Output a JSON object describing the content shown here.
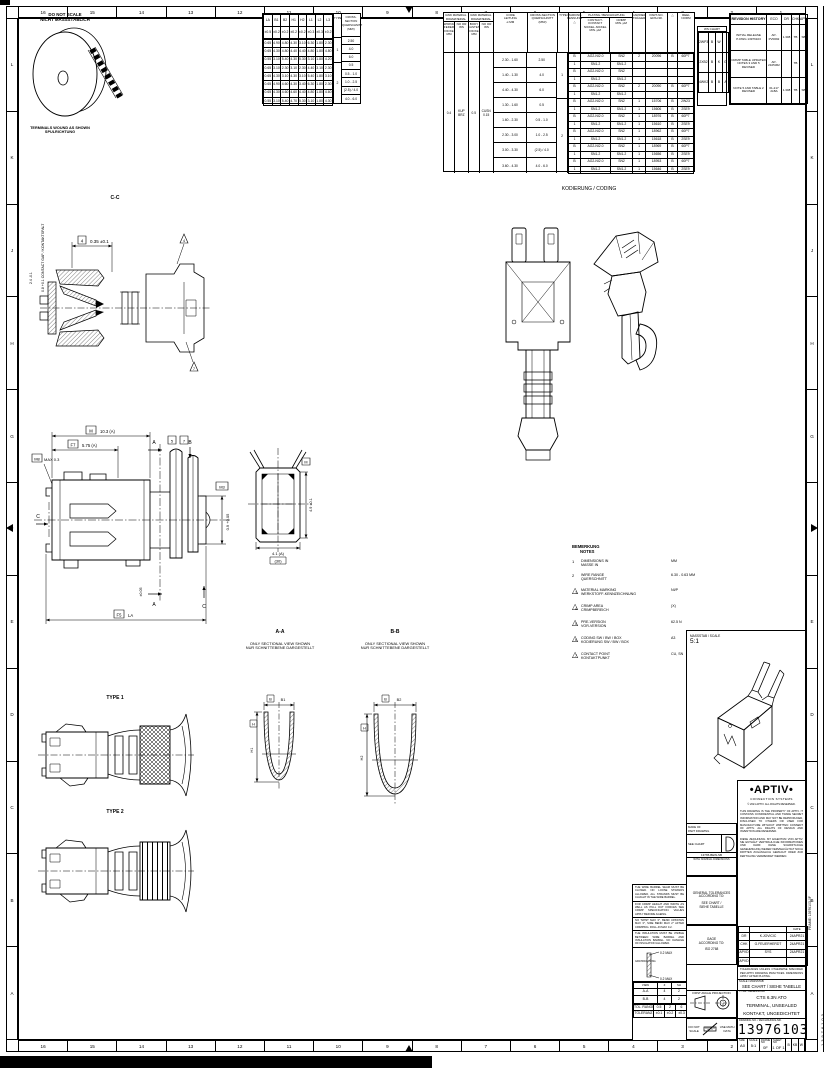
{
  "sheet": {
    "zones_h": [
      "16",
      "15",
      "14",
      "13",
      "12",
      "11",
      "10",
      "9",
      "8",
      "7",
      "6",
      "5",
      "4",
      "3",
      "2",
      "1"
    ],
    "zones_v": [
      "L",
      "K",
      "J",
      "H",
      "G",
      "F",
      "E",
      "D",
      "C",
      "B",
      "A"
    ],
    "frame_note": "FRAME: 13976103-0F",
    "doc_note": "13976103"
  },
  "top_left": {
    "dns1": "DO NOT SCALE",
    "dns2": "NICHT MASSSTÄBLICH",
    "wound1": "TERMINALS WOUND AS SHOWN",
    "wound2": "SPULRICHTUNG"
  },
  "dim_table": {
    "hdr_rows": [
      [
        "LA",
        "B1",
        "B2",
        "H1",
        "H2",
        "L1",
        "L2",
        "L3"
      ],
      [
        "±0.5",
        "±0.2",
        "±0.2",
        "±0.2",
        "±0.2",
        "±0.3",
        "±0.3",
        "±0.2"
      ]
    ],
    "h_type": "TYPE",
    "h_cs": "CROSS-SECTION\nQUERSCHNITT\n(MM²)",
    "rows": [
      [
        "0.65",
        "4.90",
        "4.80",
        "4.30",
        "3.10",
        "6.30",
        "1.80",
        "2.30"
      ],
      [
        "0.65",
        "4.30",
        "4.80",
        "4.40",
        "4.40",
        "4.80",
        "1.80",
        "4.80"
      ],
      [
        "0.55",
        "3.10",
        "5.40",
        "4.30",
        "5.30",
        "3.10",
        "1.80",
        "4.20"
      ],
      [
        "0.65",
        "3.10",
        "2.30",
        "3.10",
        "2.30",
        "4.40",
        "3.10",
        "2.30"
      ],
      [
        "0.65",
        "4.30",
        "3.10",
        "4.30",
        "3.10",
        "5.40",
        "1.80",
        "3.10"
      ],
      [
        "0.65",
        "4.90",
        "4.60",
        "4.30",
        "3.40",
        "6.30",
        "1.80",
        "2.30"
      ],
      [
        "0.65",
        "4.30",
        "4.60",
        "4.60",
        "4.40",
        "4.80",
        "1.80",
        "4.60"
      ],
      [
        "0.55",
        "3.10",
        "5.40",
        "4.70",
        "5.30",
        "3.10",
        "1.80",
        "4.30"
      ]
    ],
    "type1": "1",
    "type2": "2",
    "cs": [
      "2.50",
      "4.0",
      "6.0",
      "0.5",
      "0.5 - 1.0",
      "1.0 - 2.5",
      "(2.5) / 4.0",
      "4.0 - 6.0"
    ]
  },
  "mat_table": {
    "h_raw1": "RAW MATERIAL\nROHMATERIAL",
    "h_spring": "SPRING\nFEDER\nDICKE MM",
    "h_ws1": "NO OR\nWS",
    "h_raw2": "RAW MATERIAL\nROHMATERIAL",
    "h_body": "BODY\nKASTEN\nDICKE MM",
    "h_ws2": "NO OR\nWS",
    "h_core": "CORE\nLEITUNG\n⌀ MM",
    "h_cs": "CROSS-SECTION\nQUERSCHNITT\n(MM²)",
    "h_type": "TYPE",
    "h_mark": "MARKING\nKENNUNG\n△",
    "h_plating": "PLATING / BESCHICHTUNG",
    "h_contact": "CONTACT-KONTAKT\nNICKEL-NICKEL\nMIN. µM",
    "h_crimp": "CRIMP\nMIN. µM",
    "h_carrier": "CARRIER\nTRÄGER",
    "h_part": "PART-NO.\nEDS-NR.",
    "h_flag": "△",
    "h_norm": "REEL\nNORM",
    "spring_th": "0.4",
    "spring_ws": "KUP\nBRZ",
    "body_th": "0.5",
    "body_ws": "CUSN\n0.15",
    "core": [
      "2.30 - 1.60",
      "1.40 - 1.30",
      "4.40 - 4.30",
      "1.30 - 1.60",
      "1.60 - 2.30",
      "2.30 - 3.00",
      "3.00 - 3.30",
      "3.60 - 4.30"
    ],
    "cs": [
      "2.50",
      "4.0",
      "6.0",
      "0.5",
      "0.5 - 1.0",
      "1.0 - 2.5",
      "(2.5) / 4.0",
      "4.0 - 6.0"
    ],
    "type1": "1",
    "type2": "2",
    "rows": [
      [
        "B",
        "AG2-NI2.0",
        "SN2",
        "2",
        "20096",
        "B",
        "60P7"
      ],
      [
        "1",
        "SN1.2",
        "SN1.2",
        "",
        "",
        "",
        ""
      ],
      [
        "B",
        "AG2-NI2.0",
        "SN2",
        "",
        "",
        "",
        ""
      ],
      [
        "1",
        "SN1.2",
        "SN1.2",
        "",
        "",
        "",
        ""
      ],
      [
        "B",
        "AG2-NI2.0",
        "SN2",
        "2",
        "20090",
        "B",
        "60P7"
      ],
      [
        "1",
        "SN1.2",
        "SN1.2",
        "",
        "",
        "",
        ""
      ],
      [
        "B",
        "AG2-NI2.0",
        "SN2",
        "1",
        "15706",
        "B",
        "2W23"
      ],
      [
        "1",
        "SN1.2",
        "SN1.2",
        "1",
        "15606",
        "B",
        "2SE9"
      ],
      [
        "B",
        "AG2-NI2.0",
        "SN2",
        "1",
        "18976",
        "B",
        "60P7"
      ],
      [
        "1",
        "SN1.2",
        "SN1.2",
        "1",
        "15610",
        "B",
        "2SE9"
      ],
      [
        "B",
        "AG2-NI2.0",
        "SN2",
        "1",
        "18962",
        "B",
        "60P7"
      ],
      [
        "1",
        "SN1.2",
        "SN1.2",
        "1",
        "15618",
        "B",
        "2SE9"
      ],
      [
        "B",
        "AG2-NI2.0",
        "SN2",
        "1",
        "18969",
        "B",
        "60P7"
      ],
      [
        "1",
        "SN1.2",
        "SN1.2",
        "1",
        "15656",
        "B",
        "2SE9"
      ],
      [
        "B",
        "AG2-NI2.0",
        "SN2",
        "1",
        "18953",
        "B",
        "60P7"
      ],
      [
        "1",
        "SN1.2",
        "SN1.2",
        "1",
        "15646",
        "B",
        "2SE9"
      ]
    ]
  },
  "ws_table": {
    "title": "WS CHART",
    "rows": [
      [
        "2WP3",
        "B",
        "W",
        ""
      ],
      [
        "2XB2",
        "B",
        "K",
        "G"
      ],
      [
        "4WK2",
        "B",
        "B",
        "A"
      ]
    ]
  },
  "rev_table": {
    "title": "REVISION HISTORY",
    "cols": [
      "ECO",
      "DR",
      "CHK",
      "APVD"
    ],
    "rows": [
      [
        "INITIAL RELEASE\nP-DWG 13976103",
        "AP-\nPV0092",
        "1.308",
        "TB",
        "SB"
      ],
      [
        "CRIMP TABLE UPDATED\nNOTES 3 AND 5 REVISED",
        "AP-\n2105362",
        "",
        "TB",
        ""
      ],
      [
        "NOTE 5 AND TABLE 2 REVISED",
        "01-217\n2LBA",
        "1.308",
        "TB",
        "SB"
      ]
    ]
  },
  "notes": {
    "t1": "BEMERKUNG",
    "t2": "NOTES",
    "items": [
      {
        "f": "1",
        "en": "DIMENSIONS IN",
        "de": "MASSE IN",
        "val": "MM"
      },
      {
        "f": "2",
        "en": "WIRE RANGE",
        "de": "QUERSCHNITT",
        "val": "6.30 - 0.63 MM"
      },
      {
        "f": "3",
        "en": "MATERIAL MARKING",
        "de": "WERKSTOFF-KENNZEICHNUNG",
        "val": "NI/P"
      },
      {
        "f": "4",
        "en": "CRIMP AREA",
        "de": "CRIMPBEREICH",
        "val": "(X)"
      },
      {
        "f": "5",
        "en": "PRE-VERSION",
        "de": "VOR-VERSION",
        "val": "62.5 N"
      },
      {
        "f": "6",
        "en": "CODING SW / BW / BOX",
        "de": "KODIERUNG SW / BW / BOX",
        "val": "A3"
      },
      {
        "f": "7",
        "en": "CONTACT POINT",
        "de": "KONTAKTPUNKT",
        "val": "CU, SN"
      }
    ]
  },
  "dw": {
    "coding": "KODIERUNG / CODING",
    "cc_title": "C-C",
    "cc_dim": "0.35 ±0.1",
    "cc_balloon": "4",
    "cc_flag1": "4",
    "cc_flag2": "7",
    "cc_vlabel": "0.8 +0.1  CONTACT GAP / KONTAKTSPALT",
    "cc_vlabel2": "2.4 -0.1",
    "mv_dim1_b": "M",
    "mv_dim1": "10.3 (A)",
    "mv_dim2_b": "F7",
    "mv_dim2": "5.75 (A)",
    "mv_dim3_b": "M8",
    "mv_dim3": "MAX 0.3",
    "mv_dim4_b": "F5",
    "mv_dim4": "LA",
    "mv_dim5_b": "M3",
    "mv_dim5": "0.9 +0.05",
    "mv_b5": "5",
    "mv_b7": "7",
    "mv_a": "A",
    "mv_b": "B",
    "mv_c": "C",
    "mv_rot": "±0.05",
    "fv_dim1": "4.1 (A)",
    "fv_dim2": "(30)",
    "fv_dim3": "4.9 ±0.1",
    "fv_dim3_b": "M",
    "aa_title": "A-A",
    "bb_title": "B-B",
    "sec_note1": "ONLY SECTIONAL VIEW SHOWN",
    "sec_note2": "NUR SCHNITTEBENE DARGESTELLT",
    "aa_b": "B",
    "aa_bv": "B1",
    "aa_h": "H",
    "aa_hv": "H1",
    "bb_b": "B",
    "bb_bv": "B2",
    "bb_h": "H",
    "bb_hv": "H2",
    "type1": "TYPE 1",
    "type2": "TYPE 2",
    "scale_label": "MASSSTAB / SCALE",
    "scale_value": "5:1"
  },
  "bn": {
    "p1": "THE WIRE BARREL SEAM MUST BE CLOSED. NO LOOSE STRANDS ALLOWED, ALL STRANDS MUST BE CAUGHT IN THE WIRE BARREL.",
    "p2": "FOR CRIMP HEIGHT AND WIDTH AS WELL AS PULL OUT FORCES SEE CRIMP SPECIFICATION. VALUES APPLY BEFORE AGEING.",
    "p3": "NO TWIST MAX 3°, BEND UP/DOWN MAX 3°, SIDE BEND MAX 2° AFTER CRIMPING. ROLL-IN MAX 0.2.",
    "p4": "THE INSULATION MUST BE VISIBLE BETWEEN WIRE BARREL AND INSULATION BARREL. NO DAMAGE OF INSULATION ALLOWED.",
    "burr1": "0.2 MAX",
    "burr2": "0.2 MAX",
    "burr_cap1": "BURR ORIENTATION",
    "burr_cap2": "GRATRICHTUNG",
    "mini_h": [
      "VIEW",
      "Z",
      "SH"
    ],
    "mini_rows": [
      [
        "A-A",
        "4",
        "2"
      ],
      [
        "B-B",
        "4",
        "2"
      ]
    ],
    "foot_rows": [
      [
        "TOL. RANGE",
        "0.5",
        "2",
        "6"
      ],
      [
        "TOLERANZ",
        "±0.1",
        "±0.2",
        "±0.3"
      ]
    ]
  },
  "tbl_left": {
    "made_of1": "MADE OF",
    "made_of2": "PART DRAWING",
    "see_chart": "SEE CHART",
    "tool": "13765-BEW-SB",
    "nominal": "WITH NOMINAL DIMENSIONS",
    "gen_tol1": "GENERAL TOLERANCES",
    "gen_tol2": "ACCORDING TO:",
    "gen_tol3": "SEE CHART /",
    "gen_tol4": "SIEHE TABELLE",
    "iso1": "GAGE",
    "iso2": "ACCORDING TO:",
    "iso3": "ISO 2768",
    "proj": "FIRST ANGLE PROJECTION",
    "dns1": "DO NOT",
    "dns2": "SCALE",
    "dns3": "USE MATH",
    "dns4": "DATA"
  },
  "tb": {
    "logo": "APTIV",
    "logo_sub": "CONNECTION SYSTEMS",
    "copyright": "© 2021 APTIV. ALL RIGHTS RESERVED.",
    "legal1": "THIS DRAWING IS THE PROPERTY OF APTIV. IT CONTAINS CONFIDENTIAL AND TRADE SECRET INFORMATION AND MAY NOT BE REPRODUCED, DISCLOSED TO OTHERS OR USED FOR MANUFACTURE WITHOUT WRITTEN CONSENT OF APTIV. ALL RIGHTS OF DESIGN AND INVENTION ARE RESERVED.",
    "legal2": "DIESE ZEICHNUNG IST EIGENTUM VON APTIV. SIE ENTHÄLT VERTRAULICHE INFORMATIONEN UND DARF OHNE SCHRIFTLICHE GENEHMIGUNG WEDER VERVIELFÄLTIGT NOCH DRITTEN ZUGÄNGLICH GEMACHT ODER ZUR FERTIGUNG VERWENDET WERDEN.",
    "sig_date_h": "DATE",
    "sigs": [
      [
        "DR",
        "K.JOVICIC",
        "24APR21"
      ],
      [
        "CHK",
        "G.FEUERHERDT",
        "24APR21"
      ],
      [
        "APVD",
        "SYS",
        "24APR21"
      ],
      [
        "APVD",
        "",
        ""
      ]
    ],
    "note_box": "TOLERANCES UNLESS OTHERWISE SPECIFIED PER APTIV DRAWING PRACTICES. DIMENSIONS APPLY AFTER PLATING.",
    "scale_label": "SCALE / MASSSTAB",
    "scale_value": "SEE CHART / SIEHE TABELLE",
    "title_label": "TITLE / BENENNUNG",
    "title1": "CTS 6.3N ATO",
    "title2": "TERMINAL, UNSEALED",
    "title3": "KONTAKT, UNGEDICHTET",
    "number_label": "DRAWING NO. / ZEICHNUNGS-NR.",
    "number": "13976103",
    "size_l": "SIZE",
    "size_v": "A0",
    "scale2_l": "SCALE",
    "scale2_v": "5:1",
    "frame_l": "FRAME NO",
    "frame_v": "0F",
    "sheet_l": "SHEET NO",
    "sheet_v": "1 OF 1",
    "extra": [
      "B",
      "KB",
      "W"
    ]
  }
}
